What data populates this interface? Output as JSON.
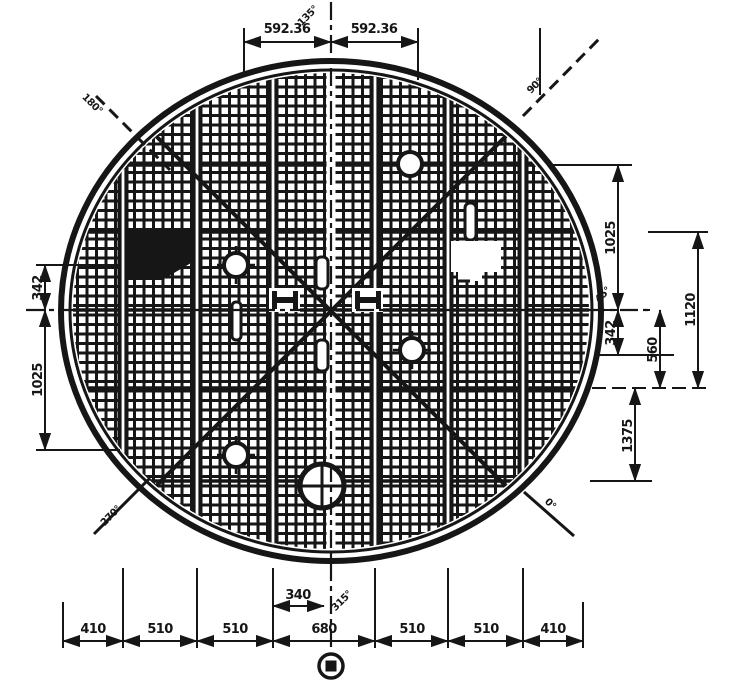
{
  "app": {
    "background": "#ffffff",
    "ink": "#161616",
    "kind": "engineering-drawing-circular-grated-plate-plan"
  },
  "drawing": {
    "angles": {
      "top_center": "135°",
      "top_left": "180°",
      "top_right": "90°",
      "right": "45°",
      "bottom_right": "0°",
      "bottom_left": "270°",
      "bottom_center": "315°"
    },
    "dims": {
      "top_left_span": "592.36",
      "top_right_span": "592.36",
      "left_upper": "342",
      "left_lower": "1025",
      "right_inner_upper": "1025",
      "right_inner_lower": "342",
      "right_mid": "560",
      "right_outer": "1120",
      "right_lower": "1375",
      "bottom_offset": "340",
      "bottom_row": [
        "410",
        "510",
        "510",
        "680",
        "510",
        "510",
        "410"
      ]
    }
  }
}
